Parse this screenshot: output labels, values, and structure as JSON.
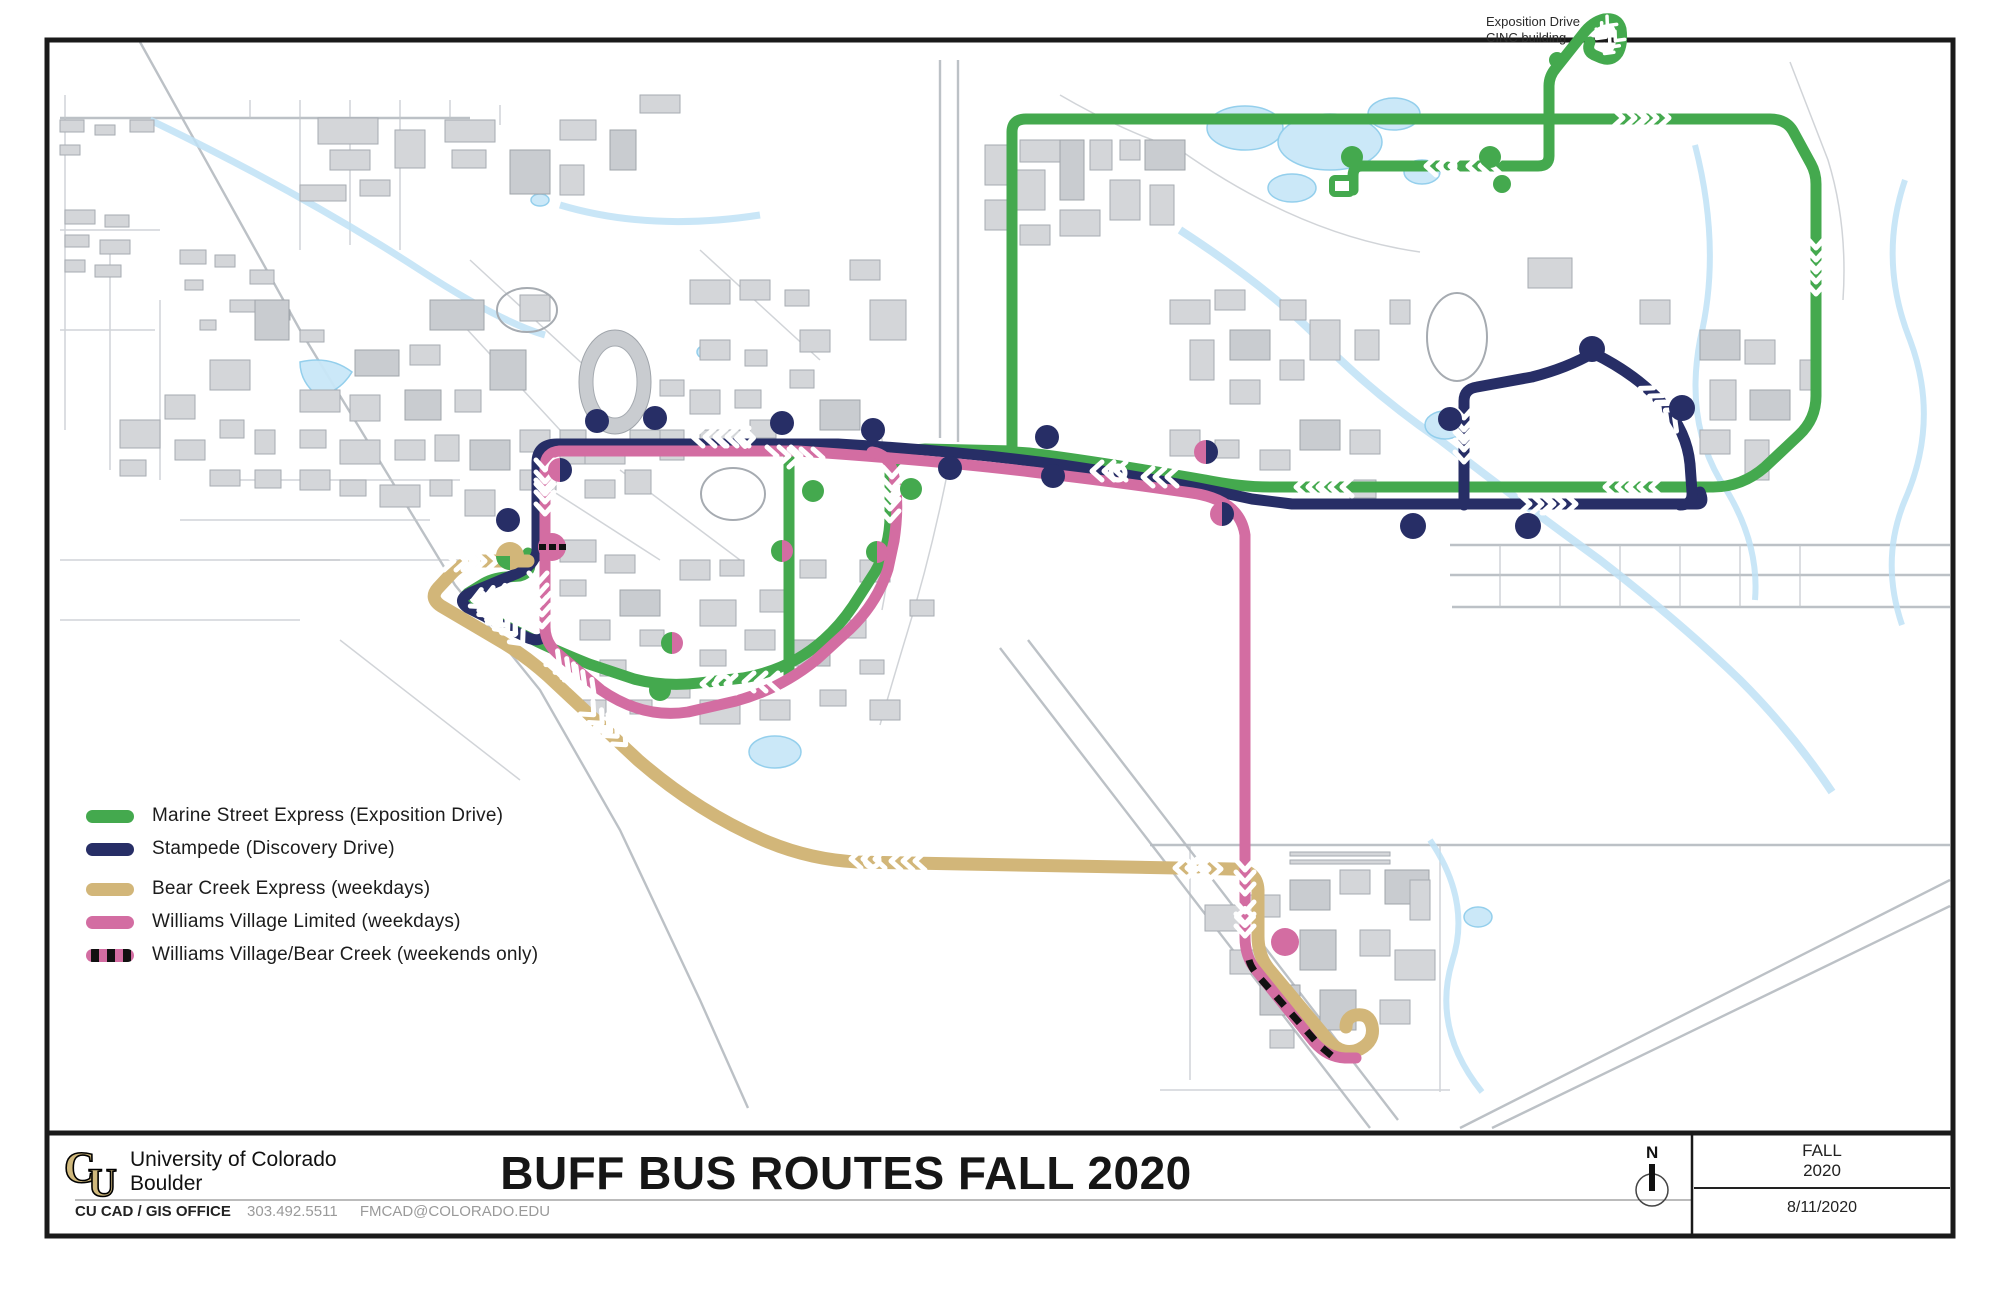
{
  "map": {
    "cinc_label": {
      "line1": "Exposition Drive",
      "line2": "CINC building"
    }
  },
  "legend": {
    "items": [
      {
        "id": "marine-street-express",
        "label": "Marine Street Express (Exposition Drive)",
        "color": "#44a94e",
        "dashed": false
      },
      {
        "id": "stampede",
        "label": "Stampede (Discovery Drive)",
        "color": "#272e66",
        "dashed": false
      },
      {
        "id": "bear-creek-express",
        "label": "Bear Creek Express (weekdays)",
        "color": "#d2b679",
        "dashed": false
      },
      {
        "id": "williams-village-limited",
        "label": "Williams Village Limited (weekdays)",
        "color": "#d36da2",
        "dashed": false
      },
      {
        "id": "williams-village-bear-creek",
        "label": "Williams Village/Bear Creek (weekends only)",
        "color": "#d36da2",
        "dashed": true
      }
    ]
  },
  "title_block": {
    "org_line1": "University of Colorado",
    "org_line2": "Boulder",
    "office": "CU CAD / GIS OFFICE",
    "phone": "303.492.5511",
    "email": "FMCAD@COLORADO.EDU",
    "title": "BUFF BUS ROUTES FALL 2020",
    "season_line1": "FALL",
    "season_line2": "2020",
    "date": "8/11/2020",
    "north_label": "N"
  },
  "colors": {
    "green": "#44a94e",
    "navy": "#272e66",
    "tan": "#d2b679",
    "pink": "#d36da2",
    "water": "#c9e7f8",
    "building": "#d4d6d9",
    "street": "#b5bac0"
  }
}
